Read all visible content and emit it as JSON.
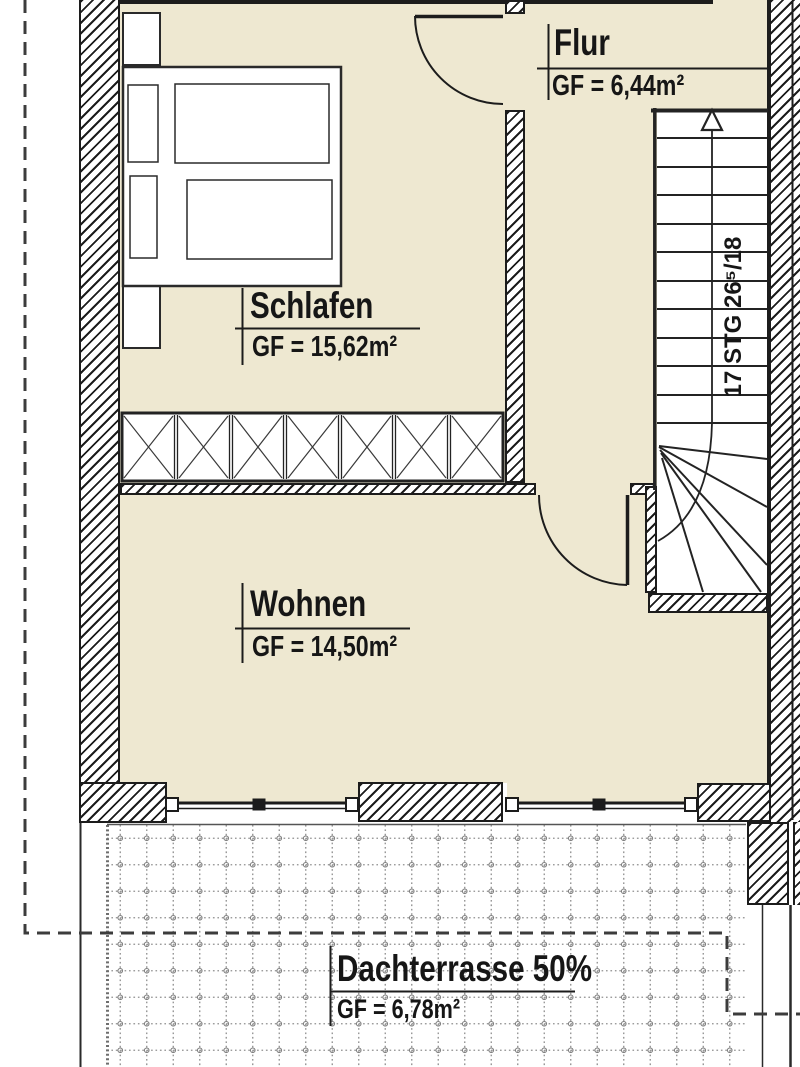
{
  "rooms": {
    "schlafen": {
      "name": "Schlafen",
      "area": "GF = 15,62m²"
    },
    "flur": {
      "name": "Flur",
      "area": "GF = 6,44m²"
    },
    "wohnen": {
      "name": "Wohnen",
      "area": "GF = 14,50m²"
    },
    "dachterrasse": {
      "name": "Dachterrasse 50%",
      "area": "GF = 6,78m²"
    }
  },
  "stairs": {
    "label": "17 STG 26⁵/18"
  },
  "colors": {
    "room_fill": "#EEE8D1",
    "wall_line": "#1c1c1c",
    "terrace_grid": "#8f8f8f",
    "boundary_dash": "#3c3c3c"
  }
}
